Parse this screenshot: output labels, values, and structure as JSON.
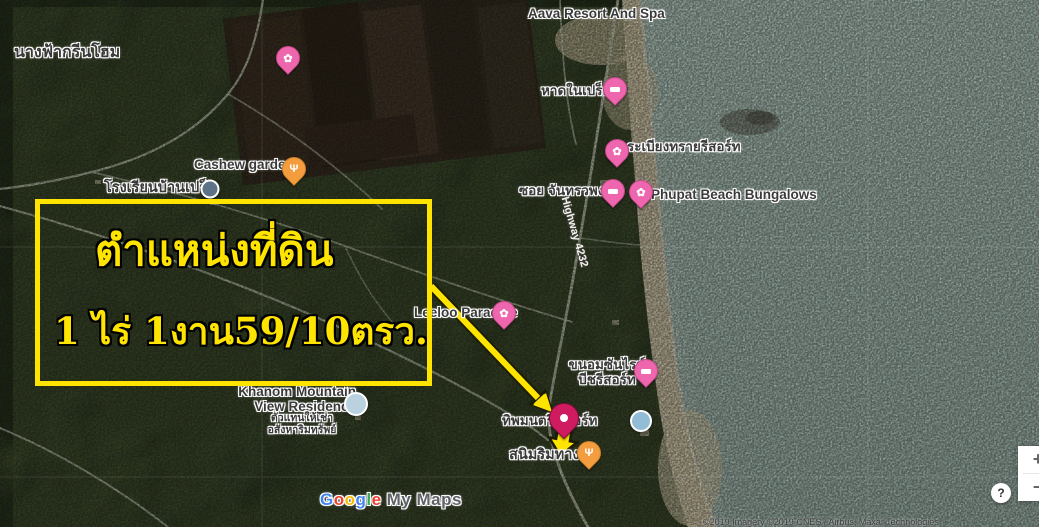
{
  "map": {
    "labels": {
      "nangfa": "นางฟ้ากรีนโฮม",
      "cashew": "Cashew garden",
      "school": "โรงเรียนบ้านเปร็ต",
      "aava": "Aava Resort And Spa",
      "hadnaipret": "หาดในเปร็ด",
      "rabiang": "ระเบียงทรายรีสอร์ท",
      "soi": "ซอย จันทรวพงค์",
      "phupat": "Phupat Beach Bungalows",
      "leeloo": "Leeloo Paradise",
      "sunrise1": "ขนอมซันไรซ์",
      "sunrise2": "บีชรีสอร์ท",
      "khanom1": "Khanom Mountain",
      "khanom2": "View Residence",
      "khanom_sub1": "ตัวแทนให้เช่า",
      "khanom_sub2": "อสังหาริมทรัพย์",
      "thip": "ทิพมนตรี รีสอร์ท",
      "sanim": "สนิมริมทาง",
      "highway": "Highway 4232"
    },
    "attribution": "©2019 Imagery ©2019 CNES / Airbus, Maxar Technologies"
  },
  "annotation": {
    "line1": "ตำแหน่งที่ดิน",
    "line2": "1 ไร่ 1งาน59/10ตรว."
  },
  "logo": {
    "letters": [
      "G",
      "o",
      "o",
      "g",
      "l",
      "e"
    ],
    "suffix": "My Maps"
  },
  "controls": {
    "zoom_in": "+",
    "zoom_out": "−",
    "help": "?"
  },
  "colors": {
    "annotation_yellow": "#FFE400",
    "pin_pink": "#EE67AE",
    "pin_orange": "#F49D3F",
    "pin_target": "#CF1B60",
    "sea": "#A9BFBA"
  }
}
